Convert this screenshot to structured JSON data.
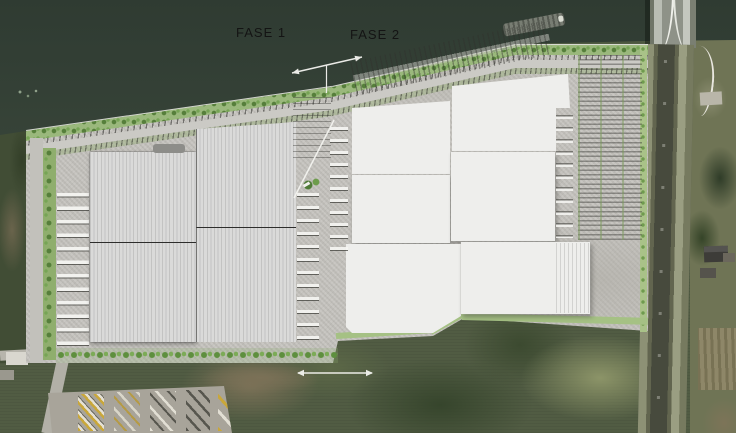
{
  "labels": {
    "phase1": "FASE 1",
    "phase2": "FASE 2"
  },
  "icons": {
    "phase_divider_arrow": "double-headed-arrow",
    "south_dimension_arrow": "double-headed-arrow",
    "leader_line": "diagonal-leader-line"
  },
  "colors": {
    "water": "#37433a",
    "site_pavement": "#c6c4bf",
    "phase1_building_fill": "#d9d9d8",
    "phase1_building_stripe": "#c3c3c2",
    "phase2_building_fill": "#eeeeec",
    "greenery_light": "#9ab87c",
    "tree_green": "#5e8f3e",
    "terrain_green": "#515c43",
    "terrain_brown": "#7b7157",
    "annotation_white": "#f2f2ef",
    "label_text": "#141414"
  }
}
